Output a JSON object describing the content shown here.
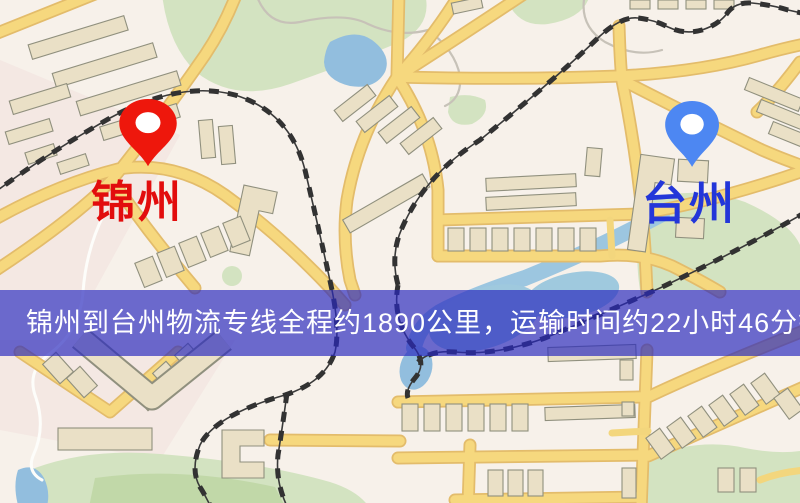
{
  "banner": {
    "text": "锦州到台州物流专线全程约1890公里，运输时间约22小时46分钟.",
    "background_color": "#2828be",
    "text_color": "#ffffff"
  },
  "markers": {
    "origin": {
      "label": "锦州",
      "pin_color": "#ee170c",
      "label_color": "#e20d0d"
    },
    "destination": {
      "label": "台州",
      "pin_color": "#4d87f2",
      "label_color": "#2336d9"
    }
  },
  "map_palette": {
    "background": "#f7f1ea",
    "road": "#f6d87e",
    "road_casing": "#e3bc6b",
    "building": "#eae0c6",
    "park": "#d3e3c1",
    "water": "#92bede",
    "railway": "#323232"
  }
}
